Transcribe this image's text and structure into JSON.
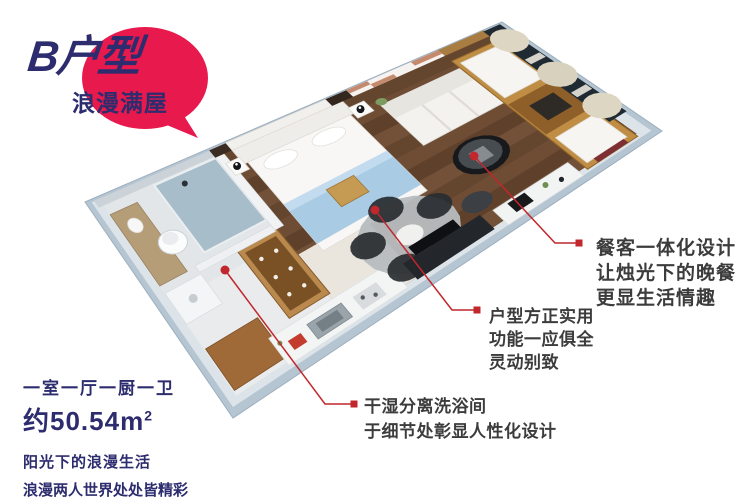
{
  "badge": {
    "title": "B户型",
    "subtitle": "浪漫满屋"
  },
  "summary": {
    "rooms": "一室一厅一厨一卫",
    "area": "约50.54m",
    "area_sup": "2",
    "tagline1": "阳光下的浪漫生活",
    "tagline2": "浪漫两人世界处处皆精彩"
  },
  "callouts": [
    {
      "id": "dining",
      "lines": [
        "餐客一体化设计",
        "让烛光下的晚餐",
        "更显生活情趣"
      ]
    },
    {
      "id": "layout",
      "lines": [
        "户型方正实用",
        "功能一应俱全",
        "灵动别致"
      ]
    },
    {
      "id": "bath",
      "lines": [
        "干湿分离洗浴间",
        "于细节处彰显人性化设计"
      ]
    }
  ],
  "palette": {
    "badge_red": "#e7194d",
    "navy": "#2d2c6e",
    "callout_red": "#c1272d",
    "text_dark": "#3c3c3c",
    "wall_gray": "#b6c5d2",
    "wood_brown": "#6a4a32"
  }
}
